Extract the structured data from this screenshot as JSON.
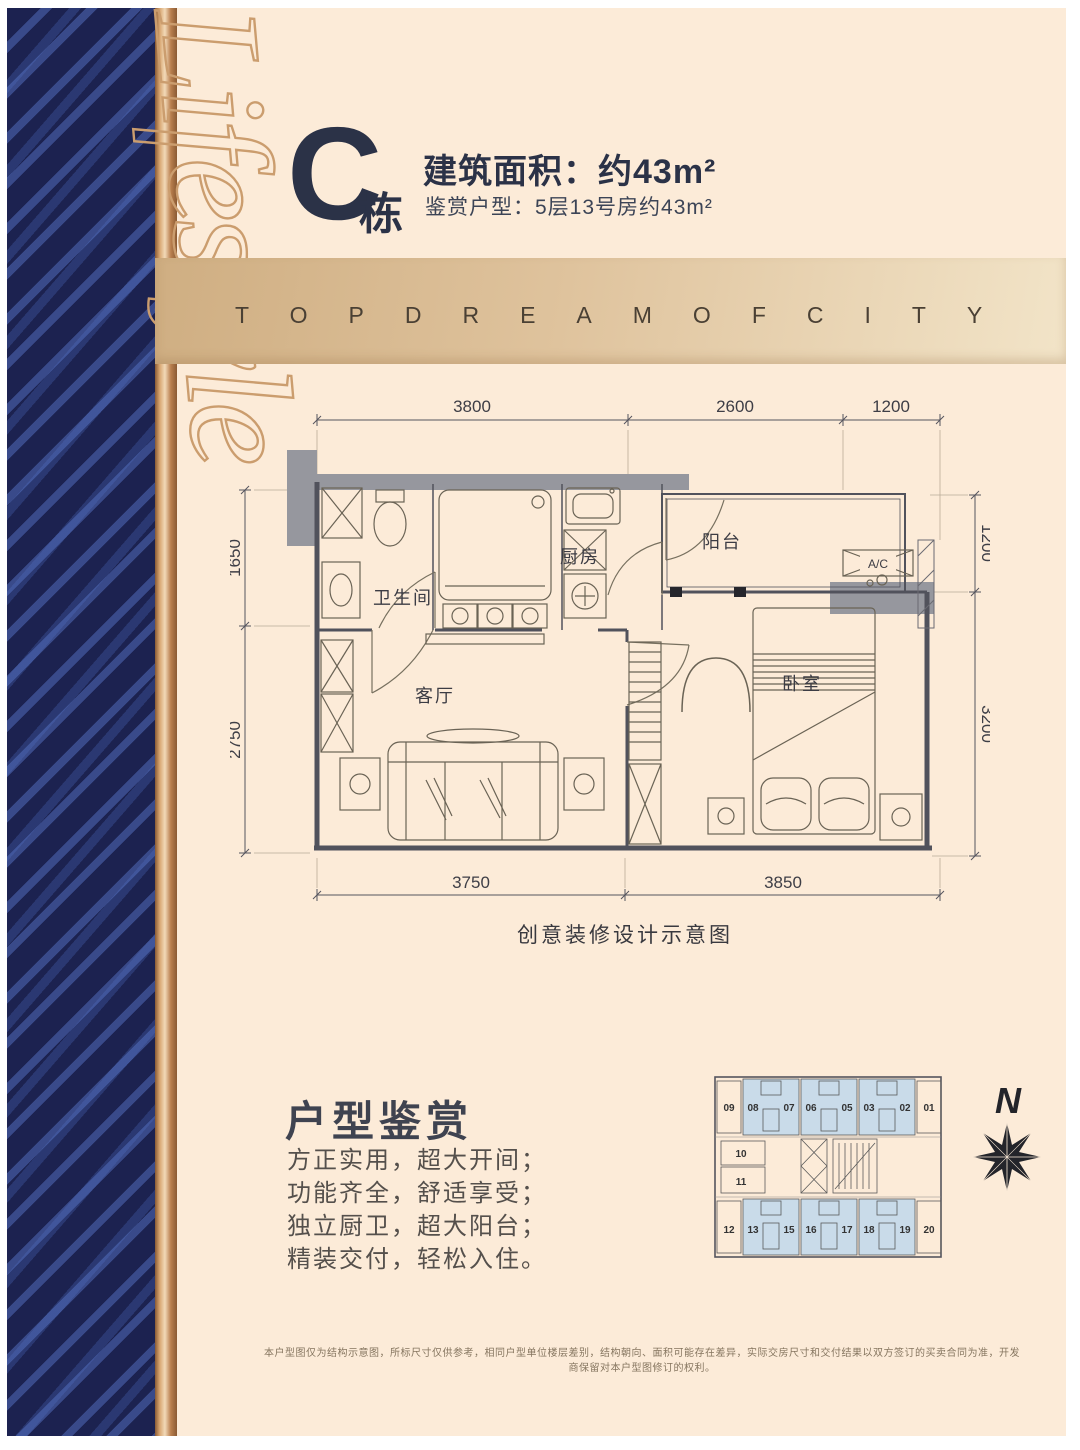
{
  "header": {
    "building_letter": "C",
    "building_suffix": "栋",
    "area_title": "建筑面积：约43m²",
    "subtitle": "鉴赏户型：5层13号房约43m²"
  },
  "banner": {
    "text": "TOP DREAM OF CITY"
  },
  "sidebar": {
    "script_text": "Lifestyle"
  },
  "floorplan": {
    "dims": {
      "top": [
        "3800",
        "2600",
        "1200"
      ],
      "left": [
        "1650",
        "2750"
      ],
      "right": [
        "1200",
        "3200"
      ],
      "bottom": [
        "3750",
        "3850"
      ]
    },
    "rooms": {
      "bathroom": "卫生间",
      "kitchen": "厨房",
      "balcony": "阳台",
      "living": "客厅",
      "bedroom": "卧室",
      "ac": "A/C"
    },
    "caption": "创意装修设计示意图"
  },
  "highlights": {
    "title": "户型鉴赏",
    "lines": [
      "方正实用，超大开间；",
      "功能齐全，舒适享受；",
      "独立厨卫，超大阳台；",
      "精装交付，轻松入住。"
    ]
  },
  "keyplan": {
    "top_units": [
      "09",
      "08",
      "07",
      "06",
      "05",
      "03",
      "02",
      "01"
    ],
    "mid_units": [
      "10",
      "11"
    ],
    "bottom_units": [
      "12",
      "13",
      "15",
      "16",
      "17",
      "18",
      "19",
      "20"
    ]
  },
  "compass": {
    "label": "N"
  },
  "disclaimer": "本户型图仅为结构示意图，所标尺寸仅供参考，相同户型单位楼层差别，结构朝向、面积可能存在差异，实际交房尺寸和交付结果以双方签订的买卖合同为准，开发商保留对本户型图修订的权利。",
  "colors": {
    "cream": "#fcebd8",
    "navy": "#1c2250",
    "stripe_blue": "#5672c4",
    "copper": "#c08a52",
    "band_from": "#cfae82",
    "band_to": "#f2e4c8",
    "text_dark": "#2b3247",
    "plan_line": "#5c5c66",
    "wall_gray": "#96979e",
    "keyplan_unit_fill": "#c9dbe9"
  }
}
